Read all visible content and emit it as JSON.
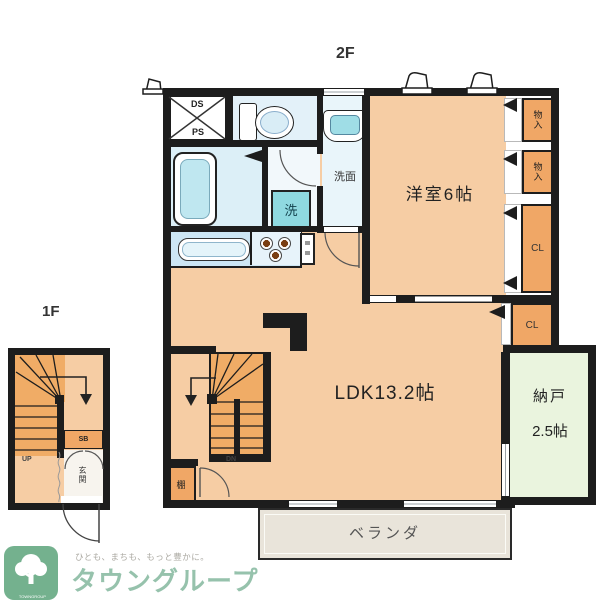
{
  "floors": {
    "f2": "2F",
    "f1": "1F"
  },
  "rooms": {
    "western": "洋室6帖",
    "ldk": "LDK13.2帖",
    "storage_name": "納戸",
    "storage_size": "2.5帖",
    "veranda": "ベランダ",
    "washroom": "洗面",
    "laundry": "洗",
    "entrance": "玄関"
  },
  "closets": {
    "upper1": "物入",
    "upper2": "物入",
    "cl_right": "CL",
    "cl_lower": "CL",
    "shelf": "棚",
    "shoebox": "SB"
  },
  "utility": {
    "ds": "DS",
    "ps": "PS"
  },
  "stairs": {
    "down": "DN",
    "up": "UP"
  },
  "logo": {
    "tagline": "ひとも、まちも、もっと豊かに。",
    "brand": "タウングループ",
    "icon_text": "TOWNGROUP"
  },
  "colors": {
    "wall": "#1d1d1d",
    "room_peach": "#F6CDA4",
    "closet_orange": "#F0A766",
    "stair_orange": "#F0AC66",
    "water_blue": "#DDEFF7",
    "fixture_teal": "#8FD9E0",
    "storage_green": "#EAF4DE",
    "veranda_gray": "#E9E4DA",
    "logo_green": "#74B18E",
    "brand_green": "#96C2AC"
  }
}
